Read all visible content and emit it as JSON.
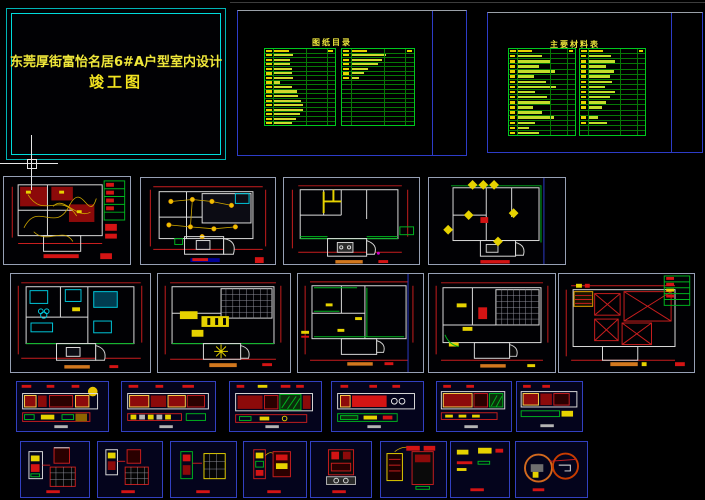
{
  "window": {
    "width": 705,
    "height": 500,
    "background": "#000000"
  },
  "title_block": {
    "project_title": "东莞厚街富怡名居6#A户型室内设计",
    "subtitle": "竣工图"
  },
  "sheet_index_frame": {
    "title": "图纸目录",
    "left_table_bars": [
      28,
      24,
      24,
      26,
      26,
      28,
      10,
      26,
      34,
      36,
      40,
      42,
      42,
      38,
      32,
      26
    ],
    "right_table_bars": [
      50,
      44,
      38,
      24,
      18,
      12,
      0,
      0,
      0,
      0,
      0,
      0,
      0,
      0,
      0,
      0
    ]
  },
  "materials_frame": {
    "title": "主要材料表",
    "left_table_bars": [
      38,
      52,
      34,
      58,
      26,
      44,
      60,
      28,
      46,
      52,
      24,
      38,
      56,
      28,
      18,
      34
    ],
    "right_table_bars": [
      36,
      42,
      28,
      40,
      34,
      38,
      26,
      42,
      34,
      28,
      22,
      0,
      16,
      30,
      0,
      0
    ]
  },
  "cursor": {
    "x": 31,
    "y": 163
  },
  "colors": {
    "frame_cyan": "#00dcdc",
    "title_yellow": "#efe73a",
    "table_green": "#00c81e",
    "table_bar_yellow": "#cfd92e",
    "dimension_red": "#c81e1e",
    "wall_white": "#dcdcdc",
    "thumb_border_grey": "#96a0b4",
    "thumb_border_blue": "#3240c0",
    "caption_orange": "#d2781e",
    "caption_navy": "#000096"
  }
}
